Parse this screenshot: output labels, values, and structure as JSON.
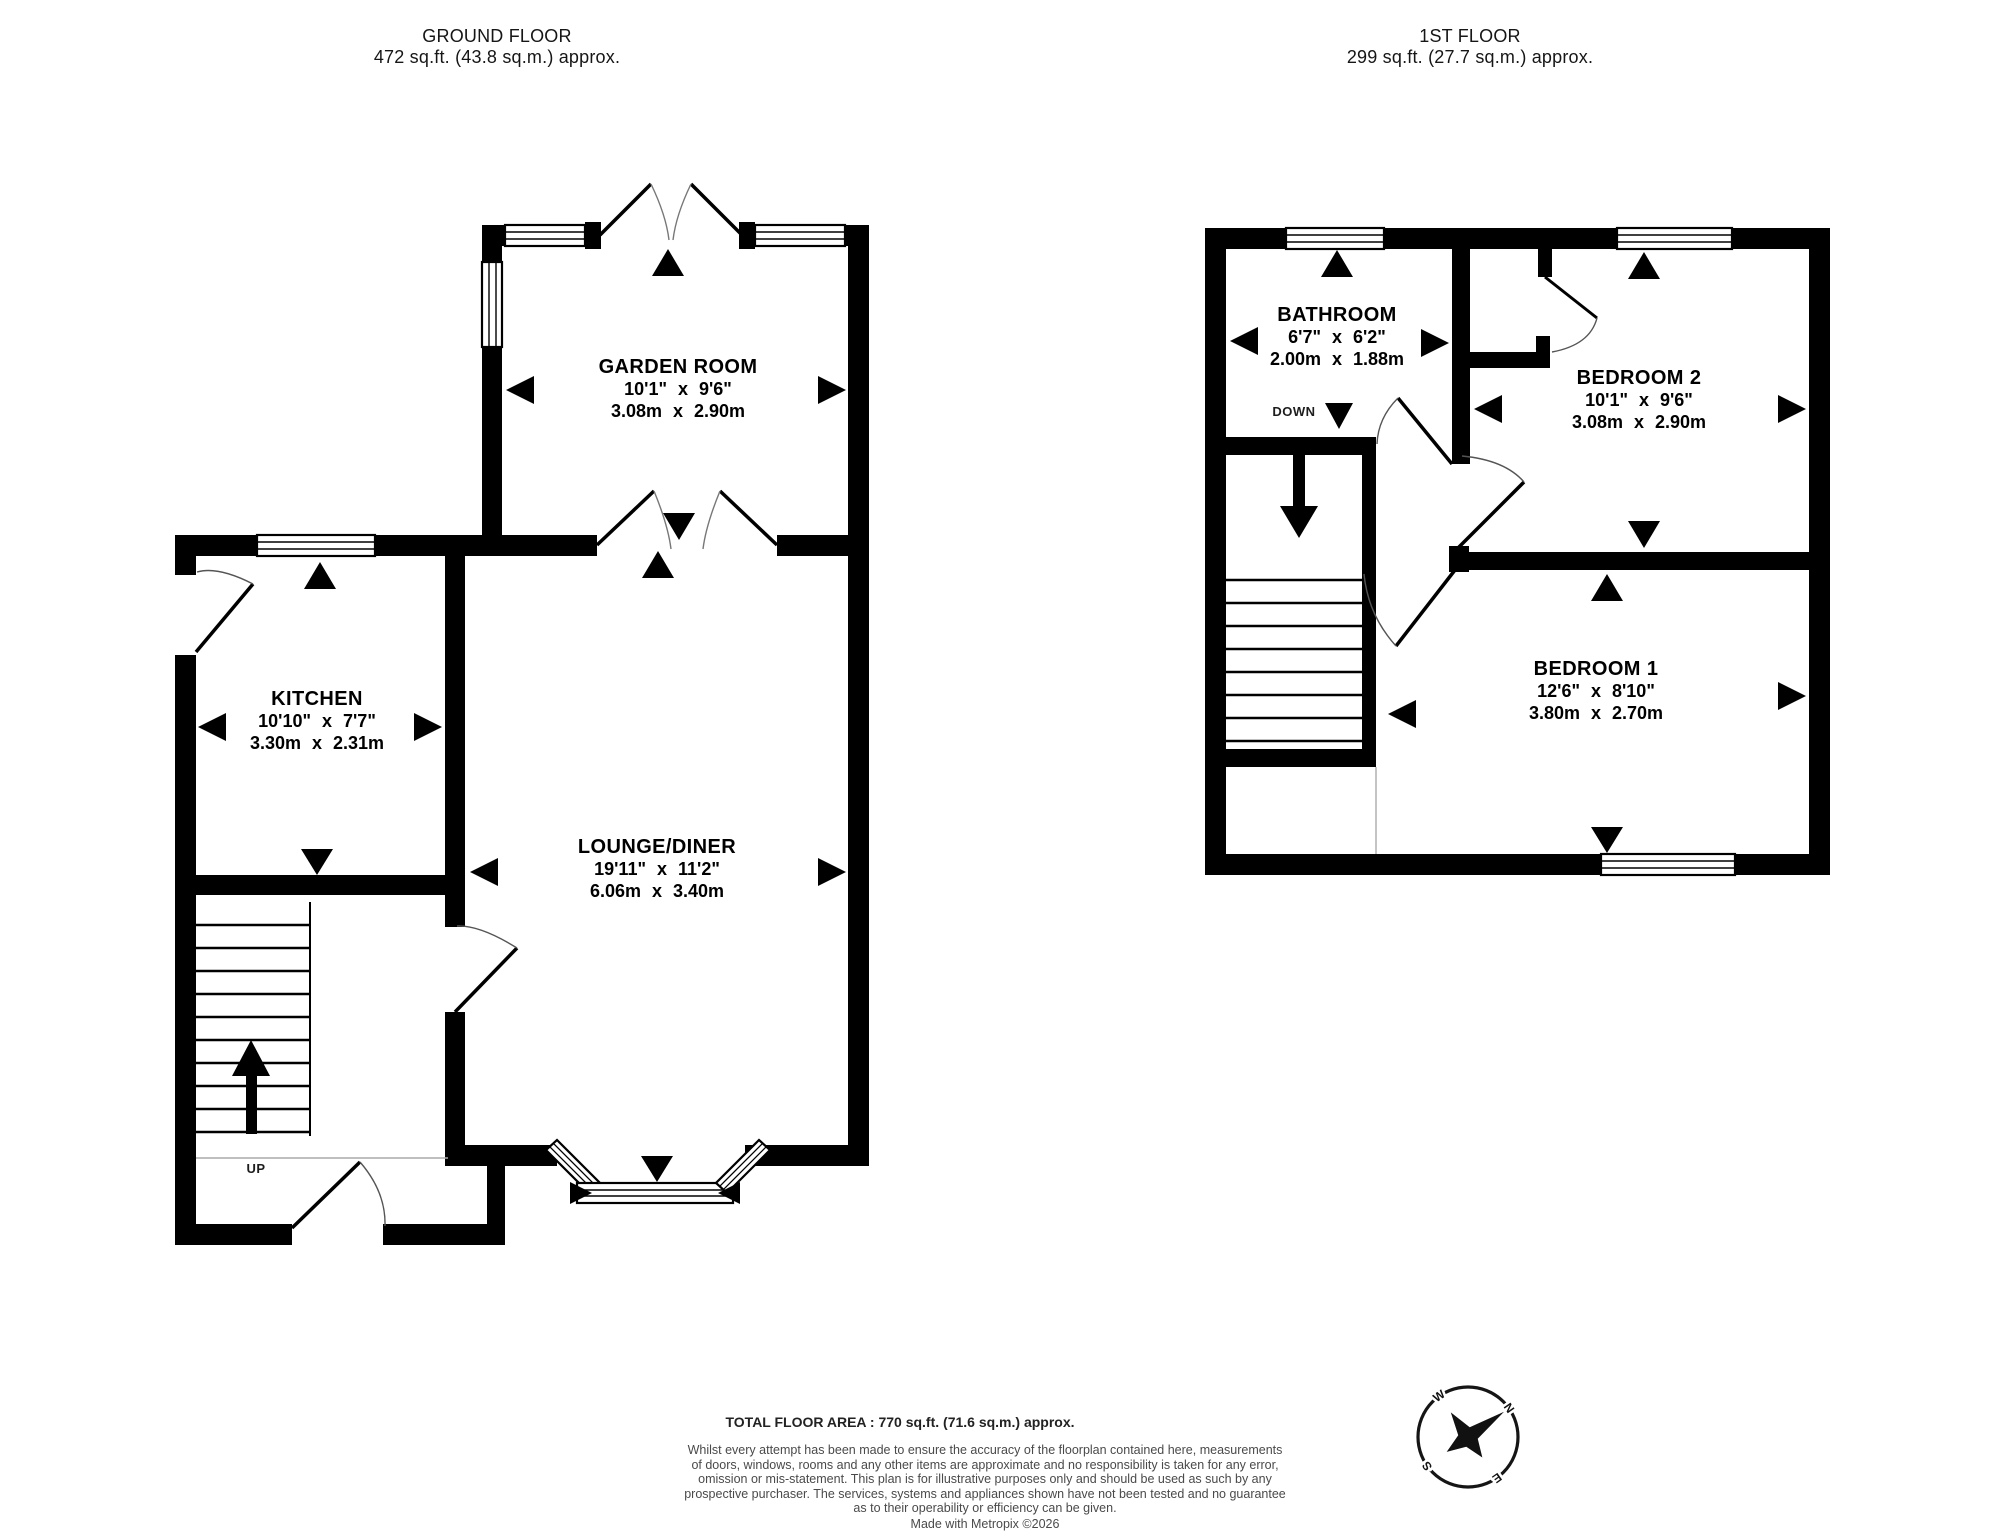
{
  "floors": [
    {
      "id": "ground",
      "title": "GROUND FLOOR",
      "area": "472 sq.ft. (43.8 sq.m.) approx.",
      "stairs_label": "UP",
      "rooms": [
        {
          "name": "GARDEN ROOM",
          "imperial": "10'1\"  x 9'6\"",
          "metric": "3.08m  x 2.90m"
        },
        {
          "name": "KITCHEN",
          "imperial": "10'10\"  x 7'7\"",
          "metric": "3.30m  x 2.31m"
        },
        {
          "name": "LOUNGE/DINER",
          "imperial": "19'11\"  x 11'2\"",
          "metric": "6.06m  x 3.40m"
        }
      ]
    },
    {
      "id": "first",
      "title": "1ST FLOOR",
      "area": "299 sq.ft. (27.7 sq.m.) approx.",
      "stairs_label": "DOWN",
      "rooms": [
        {
          "name": "BATHROOM",
          "imperial": "6'7\"  x 6'2\"",
          "metric": "2.00m  x 1.88m"
        },
        {
          "name": "BEDROOM 2",
          "imperial": "10'1\"  x 9'6\"",
          "metric": "3.08m  x 2.90m"
        },
        {
          "name": "BEDROOM 1",
          "imperial": "12'6\"  x 8'10\"",
          "metric": "3.80m  x 2.70m"
        }
      ]
    }
  ],
  "footer": {
    "total": "TOTAL FLOOR AREA : 770 sq.ft. (71.6 sq.m.) approx.",
    "disclaimer_lines": [
      "Whilst every attempt has been made to ensure the accuracy of the floorplan contained here, measurements",
      "of doors, windows, rooms and any other items are approximate and no responsibility is taken for any error,",
      "omission or mis-statement. This plan is for illustrative purposes only and should be used as such by any",
      "prospective purchaser. The services, systems and appliances shown have not been tested and no guarantee",
      "as to their operability or efficiency can be given."
    ],
    "credit": "Made with Metropix ©2026"
  },
  "compass": {
    "points": [
      "N",
      "E",
      "S",
      "W"
    ],
    "rotation_deg": 55
  },
  "colors": {
    "wall": "#000000",
    "background": "#ffffff",
    "text": "#000000",
    "disclaimer": "#4a4a4a"
  }
}
